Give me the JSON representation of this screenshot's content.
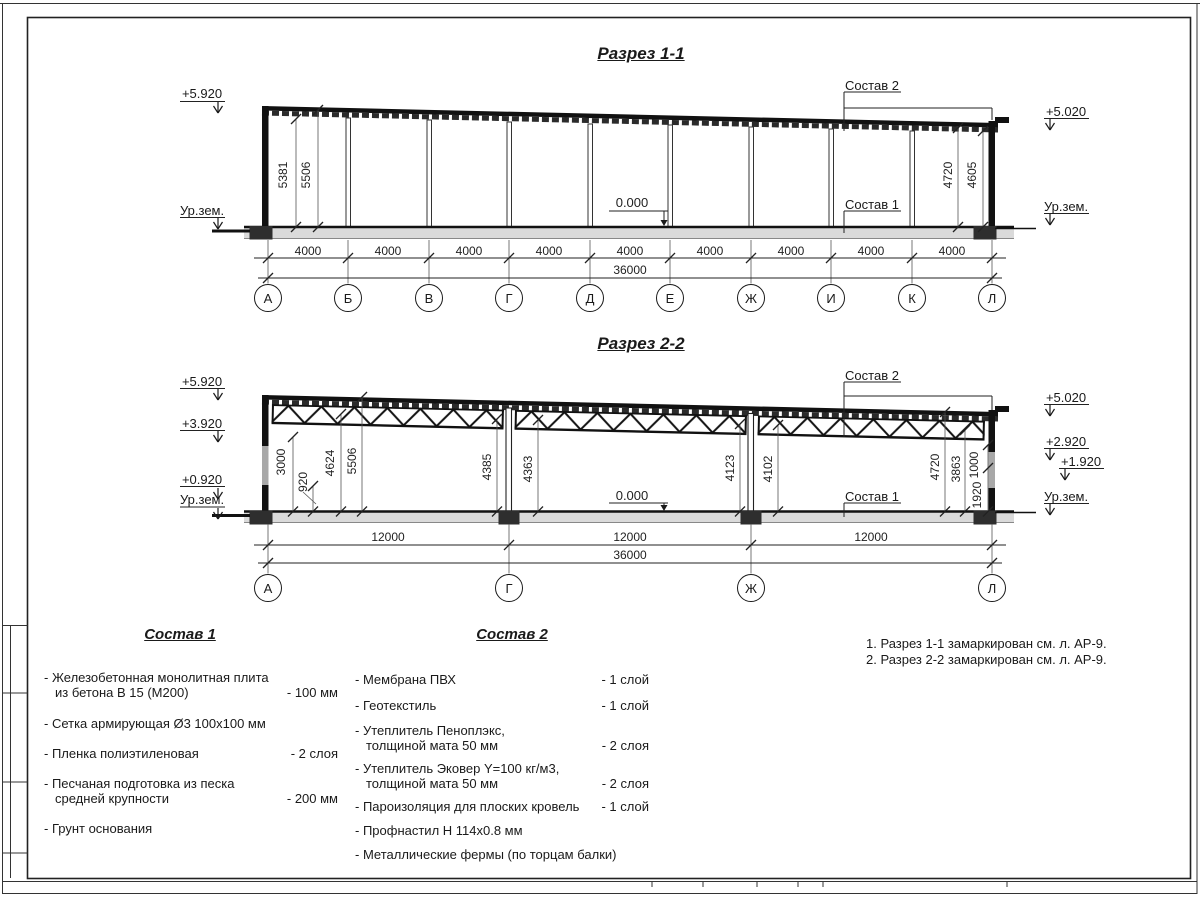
{
  "sections": {
    "s1": {
      "title": "Разрез 1-1",
      "elev": {
        "lt": "+5.920",
        "lg": "Ур.зем.",
        "rt": "+5.020",
        "rg": "Ур.зем."
      },
      "callouts": {
        "top": "Состав 2",
        "floor": "Состав 1",
        "zero": "0.000"
      },
      "vdims": [
        "5381",
        "5506",
        "4720",
        "4605"
      ],
      "bay": "4000",
      "total": "36000",
      "axes": [
        "А",
        "Б",
        "В",
        "Г",
        "Д",
        "Е",
        "Ж",
        "И",
        "К",
        "Л"
      ]
    },
    "s2": {
      "title": "Разрез 2-2",
      "elev": {
        "l1": "+5.920",
        "l2": "+3.920",
        "l3": "+0.920",
        "l4": "Ур.зем.",
        "r1": "+5.020",
        "r2": "+2.920",
        "r3": "+1.920",
        "r4": "Ур.зем."
      },
      "callouts": {
        "top": "Состав 2",
        "floor": "Состав 1",
        "zero": "0.000"
      },
      "vdims": [
        "3000",
        "920",
        "4624",
        "5506",
        "4385",
        "4363",
        "4123",
        "4102",
        "4720",
        "3863",
        "1000",
        "1920"
      ],
      "bay": "12000",
      "total": "36000",
      "axes": [
        "А",
        "Г",
        "Ж",
        "Л"
      ]
    }
  },
  "comp1": {
    "title": "Состав 1",
    "items": [
      {
        "text": "- Железобетонная  монолитная плита\nиз бетона В 15 (М200)",
        "qty": "- 100 мм"
      },
      {
        "text": "- Сетка армирующая Ø3 100x100 мм",
        "qty": ""
      },
      {
        "text": "- Пленка полиэтиленовая",
        "qty": "-  2 слоя"
      },
      {
        "text": "- Песчаная подготовка из песка\nсредней крупности",
        "qty": "- 200 мм"
      },
      {
        "text": "- Грунт основания",
        "qty": ""
      }
    ]
  },
  "comp2": {
    "title": "Состав 2",
    "items": [
      {
        "text": "- Мембрана ПВХ",
        "qty": "- 1 слой"
      },
      {
        "text": "- Геотекстиль",
        "qty": "- 1 слой"
      },
      {
        "text": "- Утеплитель Пеноплэкс,\nтолщиной мата 50 мм",
        "qty": "- 2 слоя"
      },
      {
        "text": "- Утеплитель Эковер Y=100 кг/м3,\nтолщиной мата 50 мм",
        "qty": "- 2 слоя"
      },
      {
        "text": "- Пароизоляция для плоских кровель",
        "qty": "- 1 слой"
      },
      {
        "text": "- Профнастил Н 114х0.8 мм",
        "qty": ""
      },
      {
        "text": "- Металлические фермы (по торцам балки)",
        "qty": ""
      }
    ]
  },
  "notes": [
    "1. Разрез 1-1 замаркирован см. л. АР-9.",
    "2. Разрез 2-2 замаркирован см. л. АР-9."
  ]
}
